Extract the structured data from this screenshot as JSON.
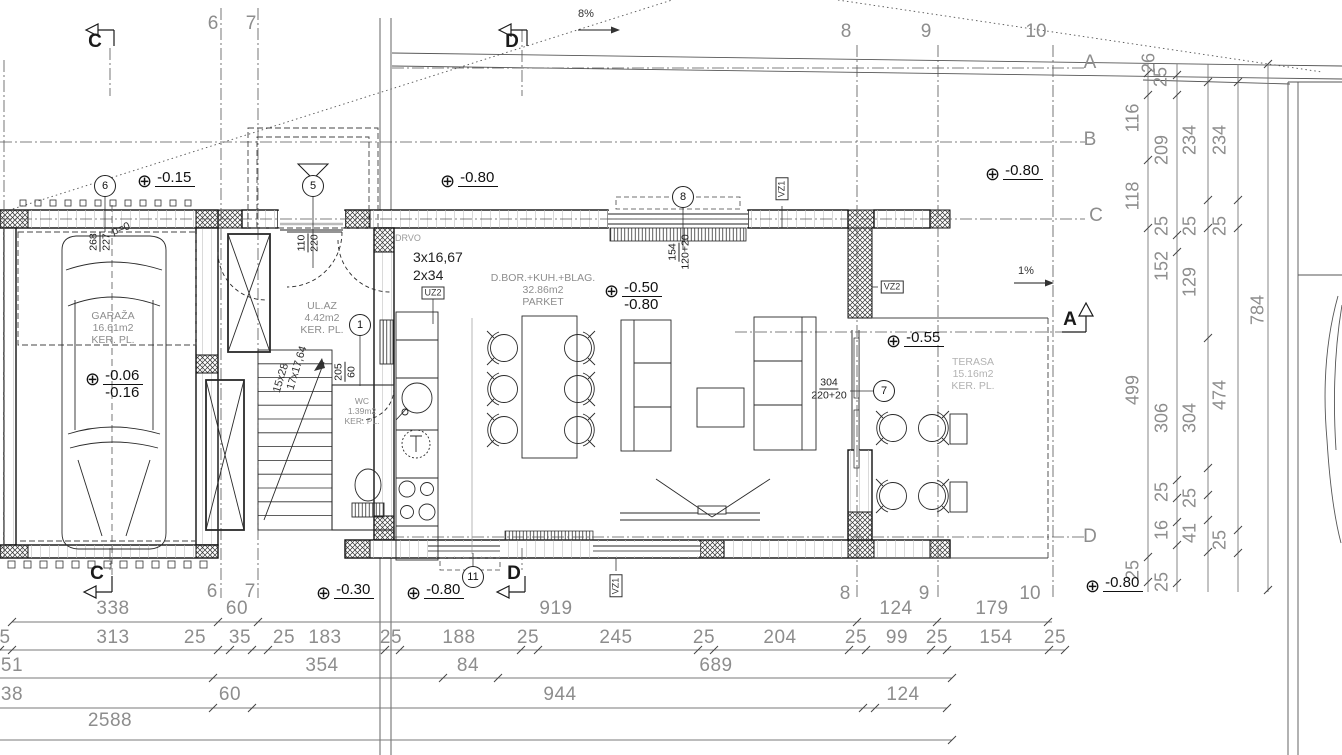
{
  "grid_top": [
    {
      "t": "6",
      "x": 213,
      "y": 13
    },
    {
      "t": "7",
      "x": 251,
      "y": 13
    },
    {
      "t": "8",
      "x": 846,
      "y": 21
    },
    {
      "t": "9",
      "x": 926,
      "y": 21
    },
    {
      "t": "10",
      "x": 1036,
      "y": 21
    }
  ],
  "grid_bottom": [
    {
      "t": "6",
      "x": 212,
      "y": 581
    },
    {
      "t": "7",
      "x": 250,
      "y": 581
    },
    {
      "t": "8",
      "x": 845,
      "y": 583
    },
    {
      "t": "9",
      "x": 924,
      "y": 583
    },
    {
      "t": "10",
      "x": 1030,
      "y": 583
    }
  ],
  "grid_right": [
    {
      "t": "A",
      "x": 1090,
      "y": 52
    },
    {
      "t": "B",
      "x": 1090,
      "y": 129
    },
    {
      "t": "C",
      "x": 1096,
      "y": 205
    },
    {
      "t": "D",
      "x": 1090,
      "y": 526
    }
  ],
  "sections": [
    {
      "t": "C",
      "x": 95,
      "y": 31
    },
    {
      "t": "D",
      "x": 512,
      "y": 31
    },
    {
      "t": "C",
      "x": 97,
      "y": 563
    },
    {
      "t": "D",
      "x": 514,
      "y": 563
    },
    {
      "t": "A",
      "x": 1070,
      "y": 309
    }
  ],
  "annotations": [
    {
      "t": "8%",
      "x": 578,
      "y": 8
    },
    {
      "t": "1%",
      "x": 1018,
      "y": 265
    },
    {
      "t": "DRVO",
      "x": 395,
      "y": 233,
      "cls": "anngray"
    },
    {
      "t": "3x16,67",
      "x": 413,
      "y": 249,
      "cls": "annmed"
    },
    {
      "t": "2x34",
      "x": 413,
      "y": 267,
      "cls": "annmed"
    },
    {
      "t": "p=0",
      "x": 121,
      "y": 229,
      "rot": -20,
      "cls": "ann"
    },
    {
      "t": "15x28",
      "x": 281,
      "y": 378,
      "rot": -73
    },
    {
      "t": "17x17,64",
      "x": 297,
      "y": 368,
      "rot": -73
    }
  ],
  "fractions": [
    {
      "top": "268",
      "bottom": "227",
      "x": 100,
      "y": 242,
      "rot": -90
    },
    {
      "top": "110",
      "bottom": "220",
      "x": 308,
      "y": 243,
      "rot": -90
    },
    {
      "top": "154",
      "bottom": "120+20",
      "x": 679,
      "y": 252,
      "rot": -90
    },
    {
      "top": "205",
      "bottom": "60",
      "x": 345,
      "y": 372,
      "rot": -90
    },
    {
      "top": "304",
      "bottom": "220+20",
      "x": 829,
      "y": 389,
      "rot": 0
    }
  ],
  "circles": [
    {
      "t": "6",
      "x": 105,
      "y": 186
    },
    {
      "t": "5",
      "x": 313,
      "y": 186
    },
    {
      "t": "8",
      "x": 683,
      "y": 197
    },
    {
      "t": "1",
      "x": 360,
      "y": 325
    },
    {
      "t": "7",
      "x": 884,
      "y": 391
    },
    {
      "t": "11",
      "x": 473,
      "y": 577
    }
  ],
  "boxes": [
    {
      "t": "UZ2",
      "x": 433,
      "y": 293
    },
    {
      "t": "VZ1",
      "x": 782,
      "y": 189,
      "v": 1
    },
    {
      "t": "VZ2",
      "x": 892,
      "y": 287
    },
    {
      "t": "VZ1",
      "x": 616,
      "y": 586,
      "v": 1
    }
  ],
  "elevations": [
    {
      "values": [
        "-0.15"
      ],
      "x": 137,
      "y": 170
    },
    {
      "values": [
        "-0.80"
      ],
      "x": 440,
      "y": 170
    },
    {
      "values": [
        "-0.80"
      ],
      "x": 985,
      "y": 163
    },
    {
      "values": [
        "-0.50",
        "-0.80"
      ],
      "x": 604,
      "y": 280
    },
    {
      "values": [
        "-0.06",
        "-0.16"
      ],
      "x": 85,
      "y": 368
    },
    {
      "values": [
        "-0.55"
      ],
      "x": 886,
      "y": 330
    },
    {
      "values": [
        "-0.30"
      ],
      "x": 316,
      "y": 582
    },
    {
      "values": [
        "-0.80"
      ],
      "x": 406,
      "y": 582
    },
    {
      "values": [
        "-0.80"
      ],
      "x": 1085,
      "y": 575
    }
  ],
  "rooms": {
    "garage": {
      "name": "GARAŽA",
      "area": "16.61m2",
      "floor": "KER. PL."
    },
    "entry": {
      "name": "UL.AZ",
      "area": "4.42m2",
      "floor": "KER. PL."
    },
    "living": {
      "name": "D.BOR.+KUH.+BLAG.",
      "area": "32.86m2",
      "floor": "PARKET"
    },
    "wc": {
      "name": "WC",
      "area": "1.39m2",
      "floor": "KER. PL."
    },
    "terrace": {
      "name": "TERASA",
      "area": "15.16m2",
      "floor": "KER. PL."
    }
  },
  "dims_bottom": [
    {
      "t": "338",
      "x": 113,
      "y": 598
    },
    {
      "t": "60",
      "x": 237,
      "y": 598
    },
    {
      "t": "919",
      "x": 556,
      "y": 598
    },
    {
      "t": "124",
      "x": 896,
      "y": 598
    },
    {
      "t": "179",
      "x": 992,
      "y": 598
    },
    {
      "t": "5",
      "x": 5,
      "y": 627
    },
    {
      "t": "313",
      "x": 113,
      "y": 627
    },
    {
      "t": "25",
      "x": 195,
      "y": 627
    },
    {
      "t": "35",
      "x": 240,
      "y": 627
    },
    {
      "t": "25",
      "x": 284,
      "y": 627
    },
    {
      "t": "183",
      "x": 325,
      "y": 627
    },
    {
      "t": "25",
      "x": 391,
      "y": 627
    },
    {
      "t": "188",
      "x": 459,
      "y": 627
    },
    {
      "t": "25",
      "x": 528,
      "y": 627
    },
    {
      "t": "245",
      "x": 616,
      "y": 627
    },
    {
      "t": "25",
      "x": 704,
      "y": 627
    },
    {
      "t": "204",
      "x": 780,
      "y": 627
    },
    {
      "t": "25",
      "x": 856,
      "y": 627
    },
    {
      "t": "99",
      "x": 897,
      "y": 627
    },
    {
      "t": "25",
      "x": 937,
      "y": 627
    },
    {
      "t": "154",
      "x": 996,
      "y": 627
    },
    {
      "t": "25",
      "x": 1055,
      "y": 627
    },
    {
      "t": "51",
      "x": 12,
      "y": 655
    },
    {
      "t": "354",
      "x": 322,
      "y": 655
    },
    {
      "t": "84",
      "x": 468,
      "y": 655
    },
    {
      "t": "689",
      "x": 716,
      "y": 655
    },
    {
      "t": "38",
      "x": 12,
      "y": 684
    },
    {
      "t": "60",
      "x": 230,
      "y": 684
    },
    {
      "t": "944",
      "x": 560,
      "y": 684
    },
    {
      "t": "124",
      "x": 903,
      "y": 684
    },
    {
      "t": "2588",
      "x": 110,
      "y": 710
    }
  ],
  "dims_right": [
    {
      "t": "26",
      "x": 1149,
      "y": 63
    },
    {
      "t": "25",
      "x": 1161,
      "y": 77
    },
    {
      "t": "116",
      "x": 1133,
      "y": 118
    },
    {
      "t": "118",
      "x": 1133,
      "y": 196
    },
    {
      "t": "499",
      "x": 1133,
      "y": 390
    },
    {
      "t": "25",
      "x": 1133,
      "y": 570
    },
    {
      "t": "209",
      "x": 1162,
      "y": 150
    },
    {
      "t": "25",
      "x": 1162,
      "y": 226
    },
    {
      "t": "152",
      "x": 1162,
      "y": 266
    },
    {
      "t": "306",
      "x": 1162,
      "y": 418
    },
    {
      "t": "25",
      "x": 1162,
      "y": 492
    },
    {
      "t": "16",
      "x": 1162,
      "y": 530
    },
    {
      "t": "25",
      "x": 1162,
      "y": 582
    },
    {
      "t": "234",
      "x": 1190,
      "y": 140
    },
    {
      "t": "25",
      "x": 1190,
      "y": 226
    },
    {
      "t": "129",
      "x": 1190,
      "y": 282
    },
    {
      "t": "304",
      "x": 1190,
      "y": 418
    },
    {
      "t": "25",
      "x": 1190,
      "y": 498
    },
    {
      "t": "41",
      "x": 1190,
      "y": 533
    },
    {
      "t": "234",
      "x": 1220,
      "y": 140
    },
    {
      "t": "25",
      "x": 1220,
      "y": 226
    },
    {
      "t": "474",
      "x": 1220,
      "y": 395
    },
    {
      "t": "25",
      "x": 1220,
      "y": 540
    },
    {
      "t": "784",
      "x": 1258,
      "y": 310
    }
  ]
}
